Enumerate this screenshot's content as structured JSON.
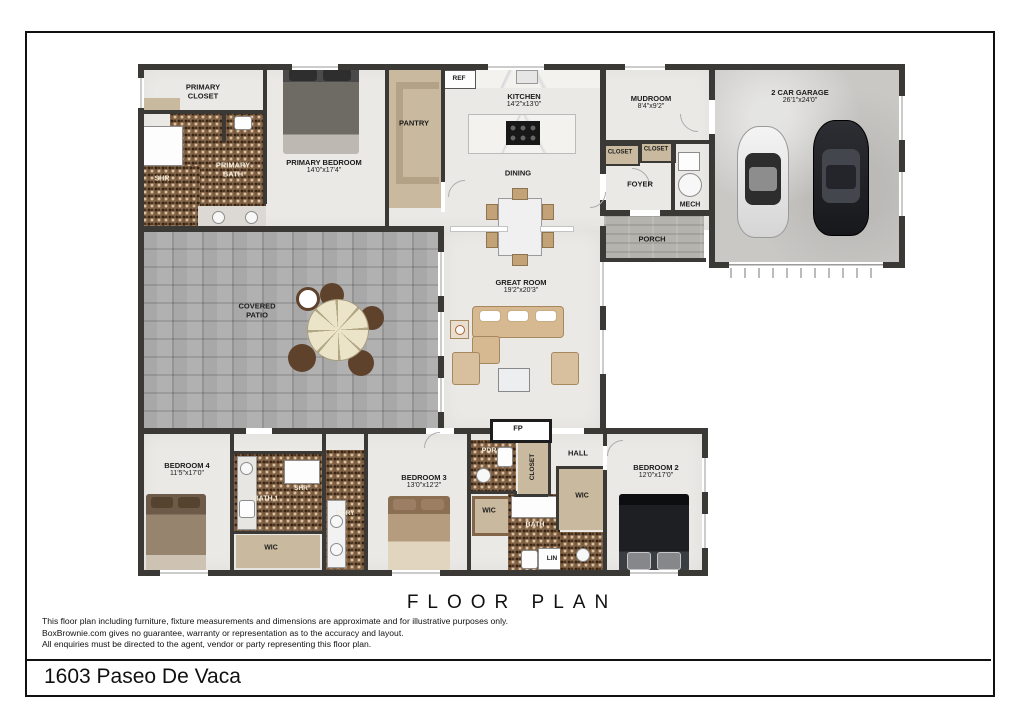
{
  "footer": {
    "title": "FLOOR PLAN",
    "address": "1603 Paseo De Vaca",
    "disclaimer": [
      "This floor plan including furniture, fixture measurements and dimensions are approximate and for illustrative purposes only.",
      "BoxBrownie.com gives no guarantee, warranty or representation as to the accuracy and layout.",
      "All enquiries must be directed to the agent, vendor or party representing this floor plan."
    ]
  },
  "rooms": {
    "primary_closet": {
      "name": "PRIMARY CLOSET"
    },
    "shr_primary": {
      "name": "SHR"
    },
    "primary_bath": {
      "name": "PRIMARY BATH"
    },
    "primary_bedroom": {
      "name": "PRIMARY BEDROOM",
      "dims": "14'0\"x17'4\""
    },
    "pantry": {
      "name": "PANTRY"
    },
    "ref": {
      "name": "REF"
    },
    "kitchen": {
      "name": "KITCHEN",
      "dims": "14'2\"x13'0\""
    },
    "dining": {
      "name": "DINING"
    },
    "mudroom": {
      "name": "MUDROOM",
      "dims": "8'4\"x9'2\""
    },
    "closet_a": {
      "name": "CLOSET"
    },
    "closet_b": {
      "name": "CLOSET"
    },
    "foyer": {
      "name": "FOYER"
    },
    "mech": {
      "name": "MECH"
    },
    "porch": {
      "name": "PORCH"
    },
    "garage": {
      "name": "2 CAR GARAGE",
      "dims": "26'1\"x24'0\""
    },
    "covered_patio": {
      "name": "COVERED PATIO"
    },
    "great_room": {
      "name": "GREAT ROOM",
      "dims": "19'2\"x20'3\""
    },
    "fireplace": {
      "name": "FP"
    },
    "bedroom4": {
      "name": "BEDROOM 4",
      "dims": "11'5\"x17'0\""
    },
    "bath1": {
      "name": "BATH 1"
    },
    "shr2": {
      "name": "SHR"
    },
    "wic_bed4": {
      "name": "WIC"
    },
    "ldry": {
      "name": "L'DRY"
    },
    "bedroom3": {
      "name": "BEDROOM 3",
      "dims": "13'0\"x12'2\""
    },
    "pdr": {
      "name": "PDR"
    },
    "closet_hall": {
      "name": "CLOSET"
    },
    "hall": {
      "name": "HALL"
    },
    "wic_bed3": {
      "name": "WIC"
    },
    "bath2": {
      "name": "BATH"
    },
    "lin": {
      "name": "LIN"
    },
    "wic_bed2": {
      "name": "WIC"
    },
    "bedroom2": {
      "name": "BEDROOM 2",
      "dims": "12'0\"x17'0\""
    }
  },
  "colors": {
    "wall": "#3a3936",
    "floor_light": "#ebe9e6",
    "floor_tan": "#c9ba9f",
    "mosaic_tile": "#83654a",
    "patio_stone": "#a8a8a8",
    "garage_concrete": "#c9c8c5",
    "frame_border": "#111111"
  }
}
